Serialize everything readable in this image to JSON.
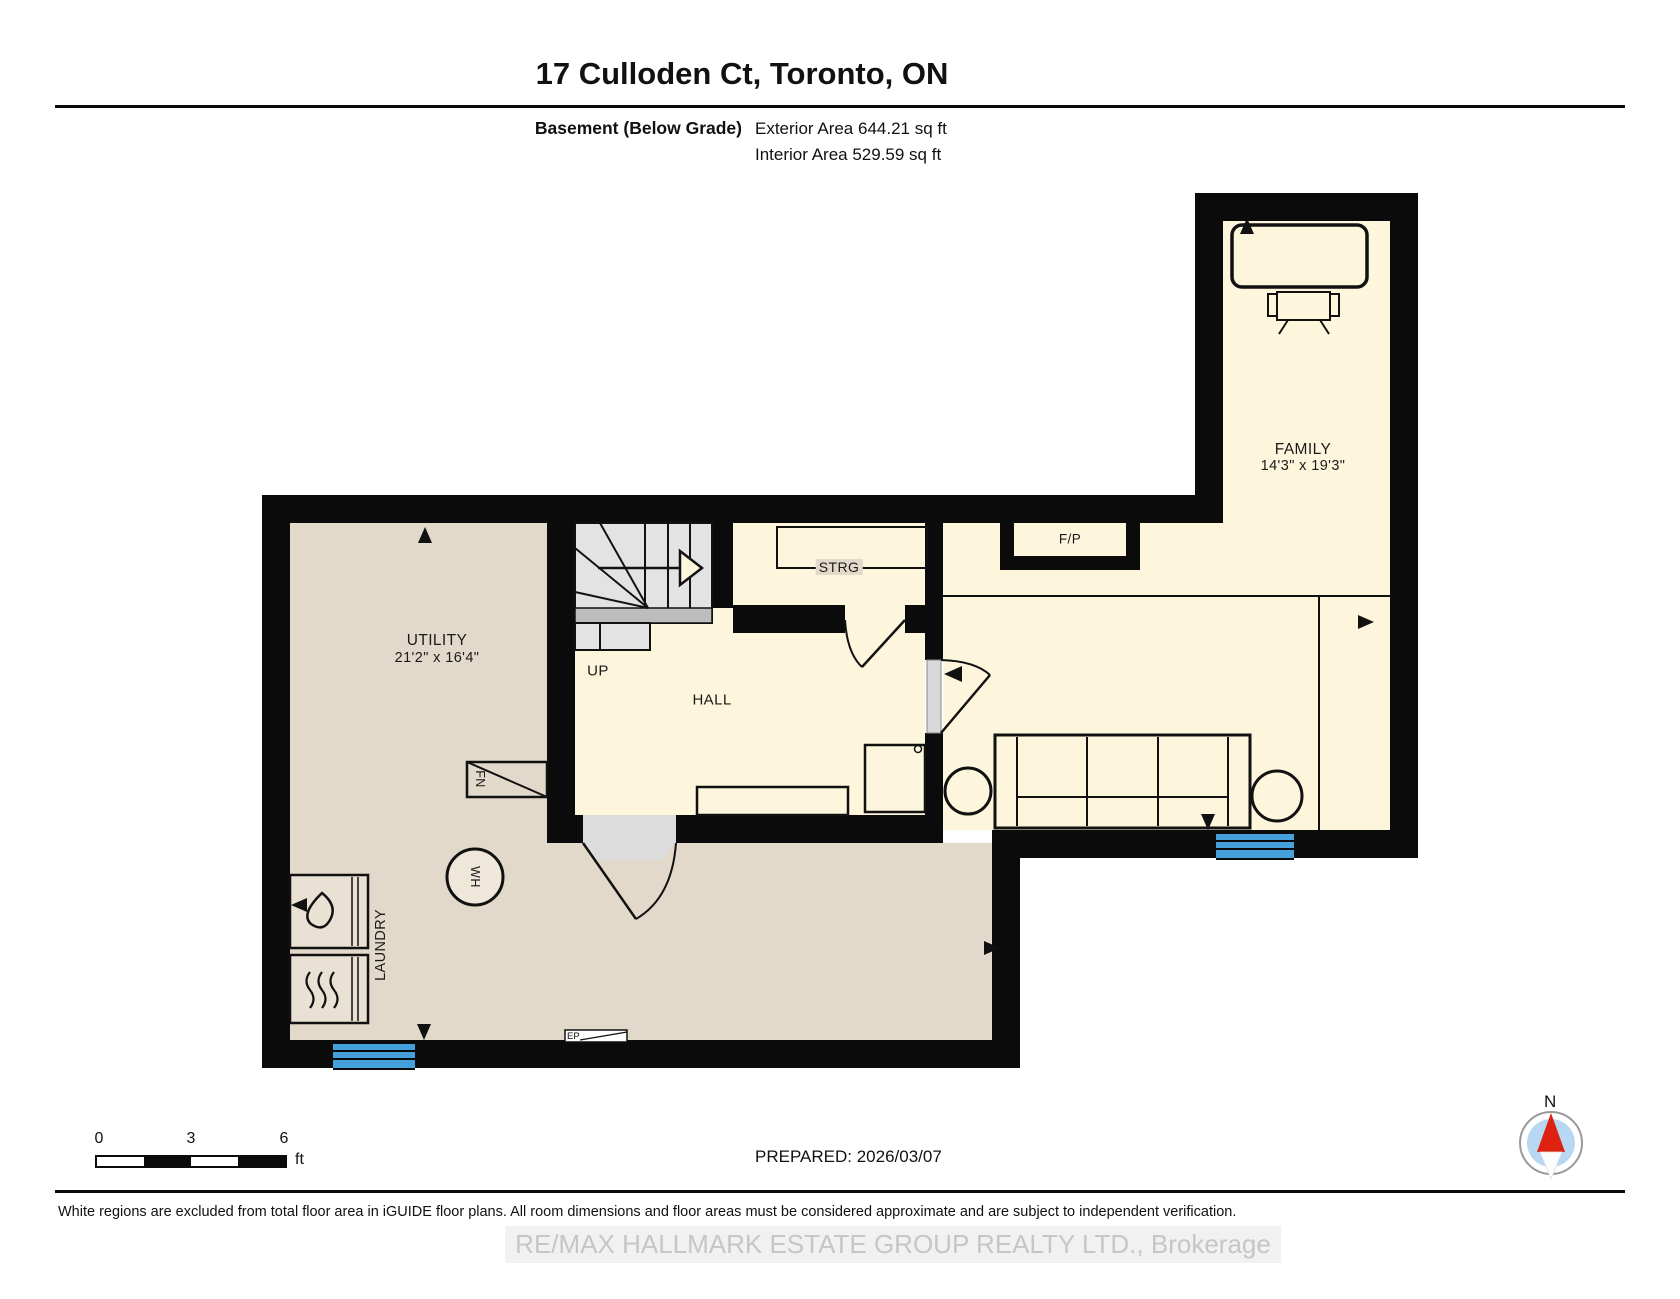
{
  "header": {
    "title": "17 Culloden Ct, Toronto, ON",
    "floor_label": "Basement (Below Grade)",
    "exterior_area": "Exterior Area 644.21 sq ft",
    "interior_area": "Interior Area 529.59 sq ft"
  },
  "rooms": {
    "family": {
      "name": "FAMILY",
      "dims": "14'3\" x 19'3\""
    },
    "utility": {
      "name": "UTILITY",
      "dims": "21'2\" x 16'4\""
    },
    "hall": {
      "name": "HALL"
    },
    "stairs": {
      "label": "UP"
    },
    "storage": {
      "label": "STRG"
    },
    "fireplace": {
      "label": "F/P"
    },
    "laundry": {
      "label": "LAUNDRY"
    }
  },
  "fixtures": {
    "furnace": "FN",
    "water_heater": "WH",
    "electrical_panel": "EP"
  },
  "icons": {
    "washer": "water-drop-icon",
    "dryer": "heat-waves-icon",
    "compass": "north-arrow-icon",
    "stairs_direction": "up-arrow-icon"
  },
  "scale_bar": {
    "tick0": "0",
    "tick1": "3",
    "tick2": "6",
    "unit": "ft"
  },
  "compass": {
    "north_label": "N"
  },
  "footer": {
    "prepared": "PREPARED: 2026/03/07",
    "disclaimer": "White regions are excluded from total floor area in iGUIDE floor plans. All room dimensions and floor areas must be considered approximate and are subject to independent verification.",
    "watermark": "RE/MAX HALLMARK ESTATE GROUP REALTY LTD., Brokerage"
  },
  "colors": {
    "wall": "#0b0b0b",
    "room_tan": "#e2d9ca",
    "room_cream": "#fdf6dd",
    "stair_gray": "#e3e3e3",
    "window_blue": "#45a1dc",
    "compass_red": "#dd2211",
    "compass_blue": "#b8d7f2",
    "watermark_gray": "#c6c6c6"
  }
}
